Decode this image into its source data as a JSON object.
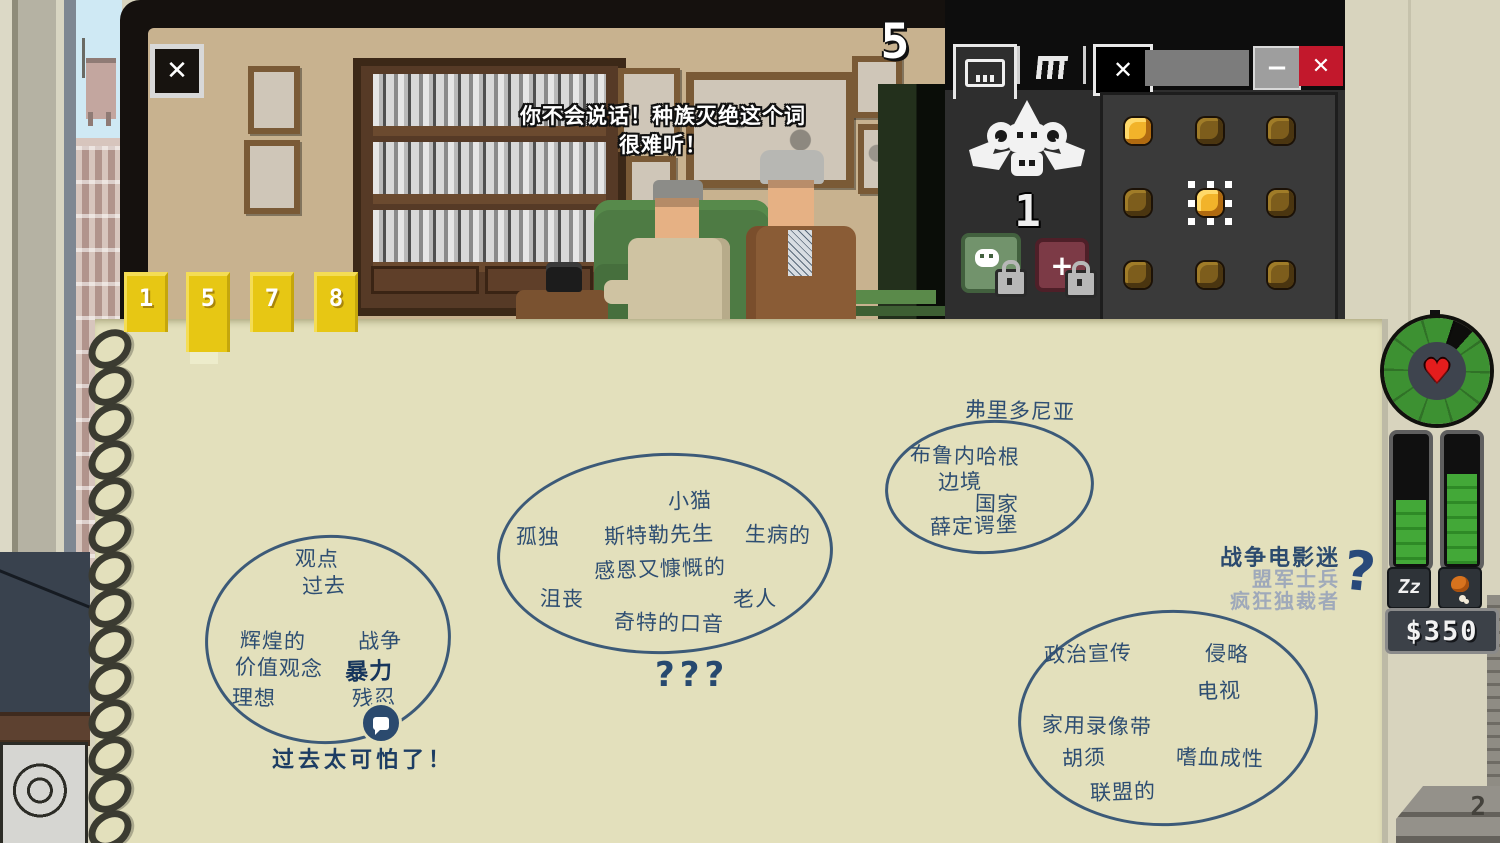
{
  "monitor": {
    "close_icon": "✕",
    "dialogue_line1": "你不会说话！种族灭绝这个词",
    "dialogue_line2": "很难听！",
    "counter": "5",
    "bookmarks": [
      "1",
      "5",
      "7",
      "8"
    ]
  },
  "monkey_window": {
    "monkey_count": "1",
    "minimize_icon": "−",
    "close_icon": "✕",
    "close_tab_icon": "✕",
    "red_item_icon": "+",
    "coins": [
      {
        "state": "bright"
      },
      {
        "state": "dim"
      },
      {
        "state": "dim"
      },
      {
        "state": "dim"
      },
      {
        "state": "selected"
      },
      {
        "state": "dim"
      },
      {
        "state": "dim"
      },
      {
        "state": "dim"
      },
      {
        "state": "dim"
      }
    ]
  },
  "hud": {
    "heart_icon": "♥",
    "sleep_label": "Zz",
    "sleep_fill_pct": "48%",
    "food_fill_pct": "68%",
    "money": "$350",
    "ruler_number": "2"
  },
  "notepad": {
    "clusters": [
      {
        "words": [
          "观点",
          "过去",
          "辉煌的",
          "战争",
          "价值观念",
          "暴力",
          "理想",
          "残忍"
        ],
        "caption": "过去太可怕了！"
      },
      {
        "words": [
          "小猫",
          "孤独",
          "斯特勒先生",
          "生病的",
          "感恩又慷慨的",
          "沮丧",
          "老人",
          "奇特的口音"
        ],
        "caption": "???"
      },
      {
        "outside": "弗里多尼亚",
        "words": [
          "布鲁内哈根",
          "边境",
          "国家",
          "薛定谔堡"
        ]
      },
      {
        "words": [
          "政治宣传",
          "侵略",
          "电视",
          "家用录像带",
          "胡须",
          "嗜血成性",
          "联盟的"
        ]
      }
    ],
    "profile": {
      "known": "战争电影迷",
      "guesses": [
        "盟军士兵",
        "疯狂独裁者"
      ],
      "mark": "?"
    }
  }
}
